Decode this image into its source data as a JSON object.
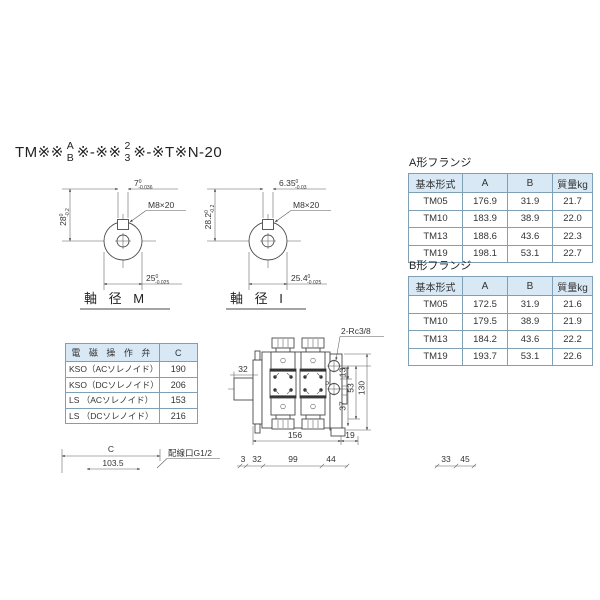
{
  "header": {
    "model_prefix": "TM※※",
    "model_stack1_top": "A",
    "model_stack1_bottom": "B",
    "model_mid": "※-※※",
    "model_stack2_top": "2",
    "model_stack2_bottom": "3",
    "model_suffix": "※-※T※N-20"
  },
  "shaft_m": {
    "label": "軸 径 M",
    "thread": "M8×20",
    "height": "28",
    "height_tol_top": "0",
    "height_tol_bottom": "-0.2",
    "key_width": "7",
    "key_tol_top": "0",
    "key_tol_bottom": "-0.036",
    "diameter": "25",
    "dia_tol_top": "0",
    "dia_tol_bottom": "-0.025"
  },
  "shaft_i": {
    "label": "軸 径 I",
    "thread": "M8×20",
    "height": "28.2",
    "height_tol_top": "0",
    "height_tol_bottom": "-0.2",
    "key_width": "6.35",
    "key_tol_top": "0",
    "key_tol_bottom": "-0.03",
    "diameter": "25.4",
    "dia_tol_top": "0",
    "dia_tol_bottom": "-0.025"
  },
  "flange_a": {
    "title": "A形フランジ",
    "headers": [
      "基本形式",
      "A",
      "B",
      "質量kg"
    ],
    "rows": [
      [
        "TM05",
        "176.9",
        "31.9",
        "21.7"
      ],
      [
        "TM10",
        "183.9",
        "38.9",
        "22.0"
      ],
      [
        "TM13",
        "188.6",
        "43.6",
        "22.3"
      ],
      [
        "TM19",
        "198.1",
        "53.1",
        "22.7"
      ]
    ]
  },
  "flange_b": {
    "title": "B形フランジ",
    "headers": [
      "基本形式",
      "A",
      "B",
      "質量kg"
    ],
    "rows": [
      [
        "TM05",
        "172.5",
        "31.9",
        "21.6"
      ],
      [
        "TM10",
        "179.5",
        "38.9",
        "21.9"
      ],
      [
        "TM13",
        "184.2",
        "43.6",
        "22.2"
      ],
      [
        "TM19",
        "193.7",
        "53.1",
        "22.6"
      ]
    ]
  },
  "solenoid_table": {
    "headers": [
      "電 磁 操 作 弁",
      "C"
    ],
    "rows": [
      [
        "KSO（ACソレノイド）",
        "190"
      ],
      [
        "KSO（DCソレノイド）",
        "206"
      ],
      [
        "LS （ACソレノイド）",
        "153"
      ],
      [
        "LS （DCソレノイド）",
        "216"
      ]
    ]
  },
  "drawing": {
    "port_label": "2-Rc3/8",
    "port_p": "P",
    "dim_shaft_len": "32",
    "dim_port_offset": "13",
    "dim_port_height": "53",
    "dim_total_height": "130",
    "dim_lower": "37",
    "dim_body_len": "156",
    "dim_end": "19",
    "chain_dims": [
      "3",
      "32",
      "99",
      "44"
    ],
    "side_dims": [
      "33",
      "45"
    ]
  },
  "bottom": {
    "c_label": "C",
    "c_value": "103.5",
    "wiring_port_label": "配線口G1/2"
  }
}
